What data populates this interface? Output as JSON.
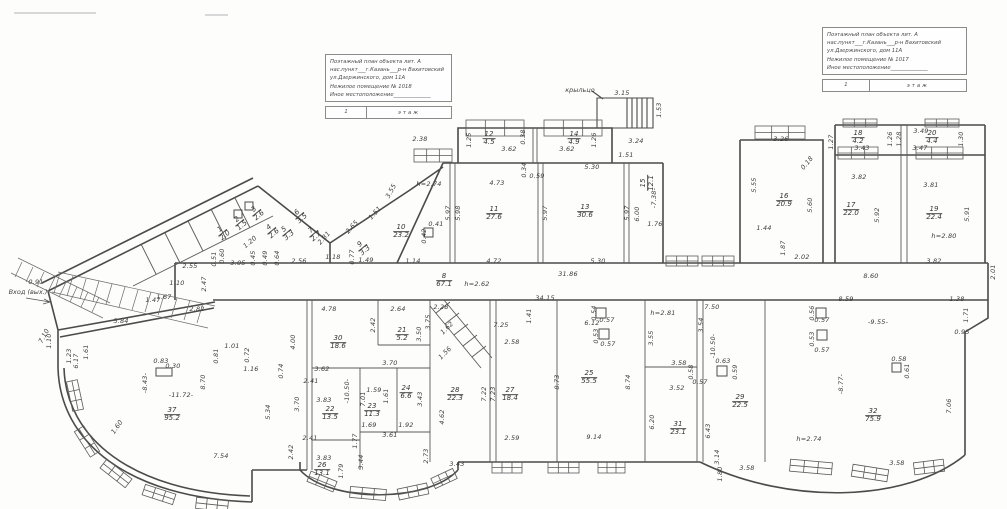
{
  "document": {
    "title_blocks": [
      {
        "position": "left",
        "lines": [
          "Поэтажный план объекта лит.  А",
          "нас.пункт___г.Казань___р-н Вахитовский",
          "ул.Дзержинского, дом 11А",
          "Нежилое помещение № 1018",
          "Иное местоположение______________"
        ],
        "floor_number": "1",
        "floor_word": "этаж"
      },
      {
        "position": "right",
        "lines": [
          "Поэтажный план объекта лит.  А",
          "нас.пункт___г.Казань___р-н Вахитовский",
          "ул.Дзержинского, дом 11А",
          "Нежилое помещение № 1017",
          "Иное местоположение______________"
        ],
        "floor_number": "1",
        "floor_word": "этаж"
      }
    ]
  },
  "plan": {
    "notes": [
      {
        "t": "крыльцо",
        "x": 580,
        "y": 90
      },
      {
        "t": "Вход (вых.)",
        "x": 28,
        "y": 292
      }
    ],
    "rooms": [
      {
        "n": "1",
        "a": "2.0",
        "x": 223,
        "y": 233,
        "r": -40
      },
      {
        "n": "2",
        "a": "1.5",
        "x": 240,
        "y": 223,
        "r": -40
      },
      {
        "n": "3",
        "a": "2.6",
        "x": 257,
        "y": 213,
        "r": -40
      },
      {
        "n": "4",
        "a": "2.6",
        "x": 272,
        "y": 231,
        "r": -40
      },
      {
        "n": "5",
        "a": "3.3",
        "x": 287,
        "y": 233,
        "r": -40
      },
      {
        "n": "6",
        "a": "3.5",
        "x": 300,
        "y": 216,
        "r": -40
      },
      {
        "n": "7",
        "a": "2.7",
        "x": 314,
        "y": 234,
        "r": -40
      },
      {
        "n": "9",
        "a": "3.3",
        "x": 363,
        "y": 248,
        "r": -40
      },
      {
        "n": "8",
        "a": "67.1",
        "x": 444,
        "y": 281
      },
      {
        "n": "10",
        "a": "23.2",
        "x": 401,
        "y": 232
      },
      {
        "n": "11",
        "a": "27.6",
        "x": 494,
        "y": 214
      },
      {
        "n": "12",
        "a": "4.5",
        "x": 489,
        "y": 139
      },
      {
        "n": "13",
        "a": "30.6",
        "x": 585,
        "y": 212
      },
      {
        "n": "14",
        "a": "4.9",
        "x": 574,
        "y": 139
      },
      {
        "n": "15",
        "a": "12.1",
        "x": 648,
        "y": 183,
        "r": -90
      },
      {
        "n": "16",
        "a": "20.9",
        "x": 784,
        "y": 201
      },
      {
        "n": "17",
        "a": "22.0",
        "x": 851,
        "y": 210
      },
      {
        "n": "18",
        "a": "4.2",
        "x": 858,
        "y": 138
      },
      {
        "n": "19",
        "a": "22.4",
        "x": 934,
        "y": 214
      },
      {
        "n": "20",
        "a": "4.4",
        "x": 932,
        "y": 138
      },
      {
        "n": "21",
        "a": "5.2",
        "x": 402,
        "y": 335
      },
      {
        "n": "22",
        "a": "13.5",
        "x": 330,
        "y": 414
      },
      {
        "n": "23",
        "a": "11.3",
        "x": 372,
        "y": 411
      },
      {
        "n": "24",
        "a": "6.6",
        "x": 406,
        "y": 393
      },
      {
        "n": "25",
        "a": "55.5",
        "x": 589,
        "y": 378
      },
      {
        "n": "26",
        "a": "13.1",
        "x": 322,
        "y": 470
      },
      {
        "n": "27",
        "a": "18.4",
        "x": 510,
        "y": 395
      },
      {
        "n": "28",
        "a": "22.3",
        "x": 455,
        "y": 395
      },
      {
        "n": "29",
        "a": "22.5",
        "x": 740,
        "y": 402
      },
      {
        "n": "30",
        "a": "18.6",
        "x": 338,
        "y": 343
      },
      {
        "n": "31",
        "a": "23.1",
        "x": 678,
        "y": 429
      },
      {
        "n": "32",
        "a": "75.9",
        "x": 873,
        "y": 416
      },
      {
        "n": "37",
        "a": "95.2",
        "x": 172,
        "y": 415
      }
    ],
    "dims": [
      {
        "t": "2.38",
        "x": 420,
        "y": 139
      },
      {
        "t": "h=2.74",
        "x": 429,
        "y": 184
      },
      {
        "t": "3.55",
        "x": 391,
        "y": 191,
        "r": -62
      },
      {
        "t": "4.73",
        "x": 497,
        "y": 183
      },
      {
        "t": "0.34",
        "x": 524,
        "y": 170,
        "r": -90
      },
      {
        "t": "0.59",
        "x": 537,
        "y": 176
      },
      {
        "t": "5.30",
        "x": 592,
        "y": 167
      },
      {
        "t": "5.97",
        "x": 448,
        "y": 213,
        "r": -90
      },
      {
        "t": "5.98",
        "x": 458,
        "y": 213,
        "r": -90
      },
      {
        "t": "0.41",
        "x": 436,
        "y": 224
      },
      {
        "t": "0.42",
        "x": 424,
        "y": 236,
        "r": -90
      },
      {
        "t": "5.97",
        "x": 545,
        "y": 213,
        "r": -90
      },
      {
        "t": "5.97",
        "x": 627,
        "y": 213,
        "r": -90
      },
      {
        "t": "6.00",
        "x": 637,
        "y": 214,
        "r": -90
      },
      {
        "t": "4.72",
        "x": 494,
        "y": 261
      },
      {
        "t": "1.14",
        "x": 413,
        "y": 261
      },
      {
        "t": "5.30",
        "x": 598,
        "y": 261
      },
      {
        "t": "31.86",
        "x": 568,
        "y": 274
      },
      {
        "t": "1.25",
        "x": 469,
        "y": 140,
        "r": -90
      },
      {
        "t": "3.62",
        "x": 509,
        "y": 149
      },
      {
        "t": "0.38",
        "x": 523,
        "y": 137,
        "r": -90
      },
      {
        "t": "3.62",
        "x": 567,
        "y": 149
      },
      {
        "t": "1.26",
        "x": 594,
        "y": 140,
        "r": -90
      },
      {
        "t": "3.15",
        "x": 622,
        "y": 93
      },
      {
        "t": "1.53",
        "x": 659,
        "y": 110,
        "r": -90
      },
      {
        "t": "3.24",
        "x": 636,
        "y": 141
      },
      {
        "t": "1.51",
        "x": 626,
        "y": 155
      },
      {
        "t": "-7.38-",
        "x": 654,
        "y": 198,
        "r": -90
      },
      {
        "t": "1.76",
        "x": 655,
        "y": 224
      },
      {
        "t": "3.26",
        "x": 781,
        "y": 139
      },
      {
        "t": "0.18",
        "x": 807,
        "y": 163,
        "r": -50
      },
      {
        "t": "1.27",
        "x": 831,
        "y": 142,
        "r": -90
      },
      {
        "t": "5.55",
        "x": 754,
        "y": 185,
        "r": -90
      },
      {
        "t": "5.60",
        "x": 810,
        "y": 205,
        "r": -90
      },
      {
        "t": "1.44",
        "x": 764,
        "y": 228
      },
      {
        "t": "1.87",
        "x": 783,
        "y": 248,
        "r": -90
      },
      {
        "t": "2.02",
        "x": 802,
        "y": 257
      },
      {
        "t": "3.49",
        "x": 921,
        "y": 131
      },
      {
        "t": "1.26",
        "x": 890,
        "y": 139,
        "r": -90
      },
      {
        "t": "1.28",
        "x": 899,
        "y": 139,
        "r": -90
      },
      {
        "t": "1.30",
        "x": 961,
        "y": 139,
        "r": -90
      },
      {
        "t": "3.43",
        "x": 862,
        "y": 148
      },
      {
        "t": "3.47",
        "x": 920,
        "y": 148
      },
      {
        "t": "3.82",
        "x": 859,
        "y": 177
      },
      {
        "t": "3.81",
        "x": 931,
        "y": 185
      },
      {
        "t": "5.92",
        "x": 877,
        "y": 215,
        "r": -90
      },
      {
        "t": "5.91",
        "x": 967,
        "y": 214,
        "r": -90
      },
      {
        "t": "h=2.80",
        "x": 944,
        "y": 236
      },
      {
        "t": "3.82",
        "x": 934,
        "y": 261
      },
      {
        "t": "8.60",
        "x": 871,
        "y": 276
      },
      {
        "t": "2.01",
        "x": 993,
        "y": 272,
        "r": -90
      },
      {
        "t": "8.59",
        "x": 846,
        "y": 299
      },
      {
        "t": "1.38",
        "x": 957,
        "y": 299
      },
      {
        "t": "-9.55-",
        "x": 878,
        "y": 322
      },
      {
        "t": "0.95",
        "x": 962,
        "y": 332
      },
      {
        "t": "1.71",
        "x": 966,
        "y": 315,
        "r": -90
      },
      {
        "t": "0.56",
        "x": 812,
        "y": 313,
        "r": -90
      },
      {
        "t": "0.57",
        "x": 822,
        "y": 320
      },
      {
        "t": "0.53",
        "x": 812,
        "y": 339,
        "r": -90
      },
      {
        "t": "0.57",
        "x": 822,
        "y": 350
      },
      {
        "t": "-8.77-",
        "x": 841,
        "y": 384,
        "r": -90
      },
      {
        "t": "h=2.74",
        "x": 809,
        "y": 439
      },
      {
        "t": "7.06",
        "x": 949,
        "y": 406,
        "r": -90
      },
      {
        "t": "3.58",
        "x": 897,
        "y": 463
      },
      {
        "t": "0.58",
        "x": 899,
        "y": 359
      },
      {
        "t": "0.61",
        "x": 907,
        "y": 371,
        "r": -90
      },
      {
        "t": "2.55",
        "x": 190,
        "y": 266
      },
      {
        "t": "1.67",
        "x": 164,
        "y": 297
      },
      {
        "t": "2.47",
        "x": 204,
        "y": 284,
        "r": -90
      },
      {
        "t": "0.51",
        "x": 214,
        "y": 259,
        "r": -90
      },
      {
        "t": "0.60",
        "x": 222,
        "y": 256,
        "r": -90
      },
      {
        "t": "3.05",
        "x": 238,
        "y": 263
      },
      {
        "t": "0.45",
        "x": 253,
        "y": 258,
        "r": -90
      },
      {
        "t": "0.49",
        "x": 265,
        "y": 258,
        "r": -90
      },
      {
        "t": "0.64",
        "x": 277,
        "y": 258,
        "r": -90
      },
      {
        "t": "2.56",
        "x": 299,
        "y": 261
      },
      {
        "t": "1.18",
        "x": 333,
        "y": 257
      },
      {
        "t": "0.77",
        "x": 352,
        "y": 257,
        "r": -90
      },
      {
        "t": "1.49",
        "x": 366,
        "y": 260
      },
      {
        "t": "h=2.62",
        "x": 477,
        "y": 284
      },
      {
        "t": "34.15",
        "x": 545,
        "y": 298
      },
      {
        "t": "h=2.81",
        "x": 663,
        "y": 313
      },
      {
        "t": "7.50",
        "x": 712,
        "y": 307
      },
      {
        "t": "2.28",
        "x": 441,
        "y": 307
      },
      {
        "t": "2.65",
        "x": 352,
        "y": 227,
        "r": -48
      },
      {
        "t": "2.81",
        "x": 324,
        "y": 238,
        "r": -48
      },
      {
        "t": "1.51",
        "x": 375,
        "y": 213,
        "r": -48
      },
      {
        "t": "1.20",
        "x": 250,
        "y": 242,
        "r": -40
      },
      {
        "t": "0.91",
        "x": 36,
        "y": 282
      },
      {
        "t": "1.10",
        "x": 177,
        "y": 283
      },
      {
        "t": "2.82",
        "x": 197,
        "y": 309
      },
      {
        "t": "1.47",
        "x": 153,
        "y": 300
      },
      {
        "t": "5.84",
        "x": 121,
        "y": 321
      },
      {
        "t": "7.10",
        "x": 44,
        "y": 336,
        "r": -62
      },
      {
        "t": "1.10",
        "x": 49,
        "y": 341,
        "r": -90
      },
      {
        "t": "1.23",
        "x": 69,
        "y": 356,
        "r": -90
      },
      {
        "t": "1.61",
        "x": 86,
        "y": 352,
        "r": -90
      },
      {
        "t": "0.83",
        "x": 161,
        "y": 361
      },
      {
        "t": "0.30",
        "x": 173,
        "y": 366
      },
      {
        "t": "8.70",
        "x": 203,
        "y": 382,
        "r": -90
      },
      {
        "t": "-8.43-",
        "x": 145,
        "y": 383,
        "r": -90
      },
      {
        "t": "-11.72-",
        "x": 181,
        "y": 395
      },
      {
        "t": "6.17",
        "x": 76,
        "y": 361,
        "r": -90
      },
      {
        "t": "1.60",
        "x": 117,
        "y": 427,
        "r": -55
      },
      {
        "t": "5.34",
        "x": 268,
        "y": 412,
        "r": -90
      },
      {
        "t": "7.54",
        "x": 221,
        "y": 456
      },
      {
        "t": "2.42",
        "x": 291,
        "y": 452,
        "r": -90
      },
      {
        "t": "3.70",
        "x": 297,
        "y": 404,
        "r": -90
      },
      {
        "t": "4.00",
        "x": 293,
        "y": 342,
        "r": -90
      },
      {
        "t": "1.01",
        "x": 232,
        "y": 346
      },
      {
        "t": "0.81",
        "x": 216,
        "y": 356,
        "r": -90
      },
      {
        "t": "0.72",
        "x": 247,
        "y": 355,
        "r": -90
      },
      {
        "t": "1.16",
        "x": 251,
        "y": 369
      },
      {
        "t": "0.74",
        "x": 281,
        "y": 371,
        "r": -90
      },
      {
        "t": "4.78",
        "x": 329,
        "y": 309
      },
      {
        "t": "2.64",
        "x": 398,
        "y": 309
      },
      {
        "t": "2.42",
        "x": 373,
        "y": 325,
        "r": -90
      },
      {
        "t": "3.50",
        "x": 419,
        "y": 334,
        "r": -90
      },
      {
        "t": "3.75",
        "x": 428,
        "y": 322,
        "r": -90
      },
      {
        "t": "1.62",
        "x": 447,
        "y": 328,
        "r": -45
      },
      {
        "t": "1.56",
        "x": 445,
        "y": 353,
        "r": -45
      },
      {
        "t": "3.62",
        "x": 322,
        "y": 369
      },
      {
        "t": "2.41",
        "x": 311,
        "y": 381
      },
      {
        "t": "3.70",
        "x": 390,
        "y": 363
      },
      {
        "t": "1.59",
        "x": 374,
        "y": 390
      },
      {
        "t": "1.61",
        "x": 386,
        "y": 396,
        "r": -90
      },
      {
        "t": "7.01",
        "x": 363,
        "y": 399,
        "r": -90
      },
      {
        "t": "-10.50-",
        "x": 347,
        "y": 391,
        "r": -90
      },
      {
        "t": "3.43",
        "x": 420,
        "y": 399,
        "r": -90
      },
      {
        "t": "3.83",
        "x": 324,
        "y": 400
      },
      {
        "t": "1.69",
        "x": 369,
        "y": 425
      },
      {
        "t": "1.92",
        "x": 406,
        "y": 425
      },
      {
        "t": "3.61",
        "x": 390,
        "y": 435
      },
      {
        "t": "1.77",
        "x": 355,
        "y": 441,
        "r": -90
      },
      {
        "t": "2.41",
        "x": 310,
        "y": 438
      },
      {
        "t": "3.83",
        "x": 324,
        "y": 458
      },
      {
        "t": "1.79",
        "x": 341,
        "y": 471,
        "r": -90
      },
      {
        "t": "3.44",
        "x": 361,
        "y": 462,
        "r": -90
      },
      {
        "t": "2.73",
        "x": 426,
        "y": 456,
        "r": -90
      },
      {
        "t": "3.43",
        "x": 457,
        "y": 464
      },
      {
        "t": "4.62",
        "x": 442,
        "y": 417,
        "r": -90
      },
      {
        "t": "7.22",
        "x": 484,
        "y": 394,
        "r": -90
      },
      {
        "t": "7.23",
        "x": 493,
        "y": 394,
        "r": -90
      },
      {
        "t": "7.25",
        "x": 501,
        "y": 325
      },
      {
        "t": "2.58",
        "x": 512,
        "y": 342
      },
      {
        "t": "1.41",
        "x": 529,
        "y": 316,
        "r": -90
      },
      {
        "t": "2.59",
        "x": 512,
        "y": 438
      },
      {
        "t": "8.73",
        "x": 557,
        "y": 382,
        "r": -90
      },
      {
        "t": "9.14",
        "x": 594,
        "y": 437
      },
      {
        "t": "8.74",
        "x": 628,
        "y": 382,
        "r": -90
      },
      {
        "t": "6.12",
        "x": 592,
        "y": 323
      },
      {
        "t": "0.54",
        "x": 594,
        "y": 313,
        "r": -90
      },
      {
        "t": "0.57",
        "x": 607,
        "y": 320
      },
      {
        "t": "0.53",
        "x": 596,
        "y": 336,
        "r": -90
      },
      {
        "t": "0.57",
        "x": 608,
        "y": 344
      },
      {
        "t": "3.55",
        "x": 651,
        "y": 338,
        "r": -90
      },
      {
        "t": "3.54",
        "x": 701,
        "y": 325,
        "r": -90
      },
      {
        "t": "3.58",
        "x": 679,
        "y": 363
      },
      {
        "t": "0.58",
        "x": 691,
        "y": 372,
        "r": -90
      },
      {
        "t": "3.52",
        "x": 677,
        "y": 388
      },
      {
        "t": "0.57",
        "x": 700,
        "y": 382
      },
      {
        "t": "6.20",
        "x": 652,
        "y": 422,
        "r": -90
      },
      {
        "t": "6.43",
        "x": 708,
        "y": 431,
        "r": -90
      },
      {
        "t": "3.14",
        "x": 717,
        "y": 457,
        "r": -90
      },
      {
        "t": "1.80",
        "x": 720,
        "y": 474,
        "r": -90
      },
      {
        "t": "3.58",
        "x": 747,
        "y": 468
      },
      {
        "t": "-10.50-",
        "x": 713,
        "y": 346,
        "r": -90
      },
      {
        "t": "0.63",
        "x": 723,
        "y": 361
      },
      {
        "t": "0.59",
        "x": 735,
        "y": 372,
        "r": -90
      }
    ]
  }
}
